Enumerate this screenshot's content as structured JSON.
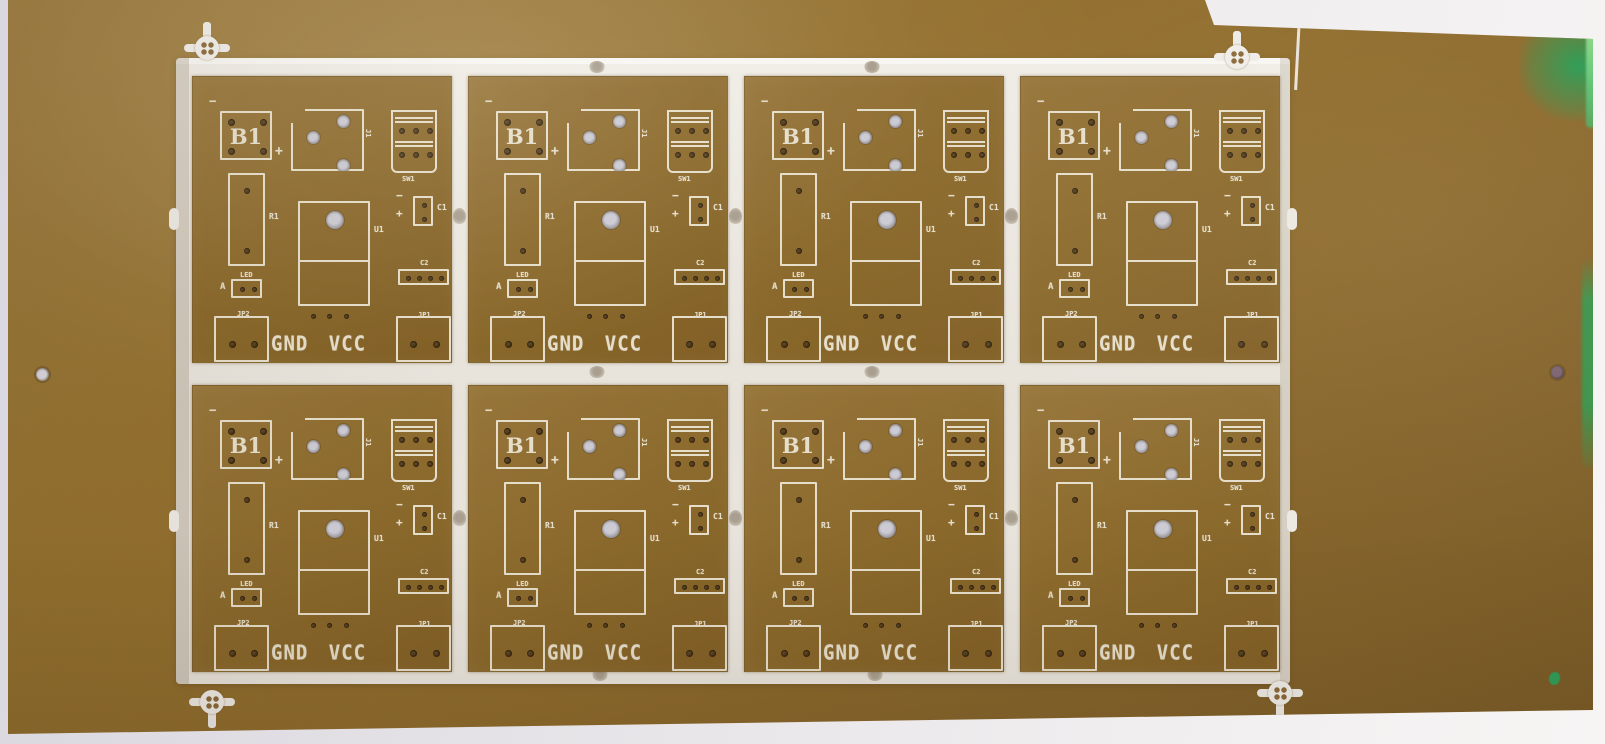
{
  "scene": {
    "description": "Photograph of a panelized printed circuit board: 8 identical bare PCBs in a 2 by 4 array on a tan FR-2 style panel, white silkscreen, routed separation channels with mouse-bite tabs, fiducial marks, on a light grey background",
    "object_type": "pcb-panel-photo"
  },
  "panel": {
    "rows": 2,
    "columns": 4,
    "board_count": 8,
    "fiducial_count": 4,
    "tooling_hole_count": 2,
    "visible_refdes_per_board": [
      "B1",
      "J1",
      "SW1",
      "R1",
      "U1",
      "C1",
      "C2",
      "LED",
      "JP1",
      "JP2"
    ]
  },
  "board_labels": {
    "battery": "B1",
    "jack": "J1",
    "switch": "SW1",
    "resistor": "R1",
    "ic": "U1",
    "cap1": "C1",
    "cap2": "C2",
    "led": "LED",
    "led_anode": "A",
    "jumper1": "JP1",
    "jumper2": "JP2",
    "power_text": "GND VCC",
    "plus": "+",
    "minus": "−"
  },
  "colors": {
    "panel_brown": "#8f6c2e",
    "panel_brown_light": "#9c7b40",
    "panel_brown_dark": "#775a26",
    "board_brown": "#916e31",
    "silkscreen_white": "#ece5d2",
    "channel_white": "#e9e5de",
    "background_grey": "#e4e2e6",
    "green_specks": "#2f9e58",
    "hole_dark": "#32220d",
    "hole_plated_light": "#c6c3cb"
  }
}
